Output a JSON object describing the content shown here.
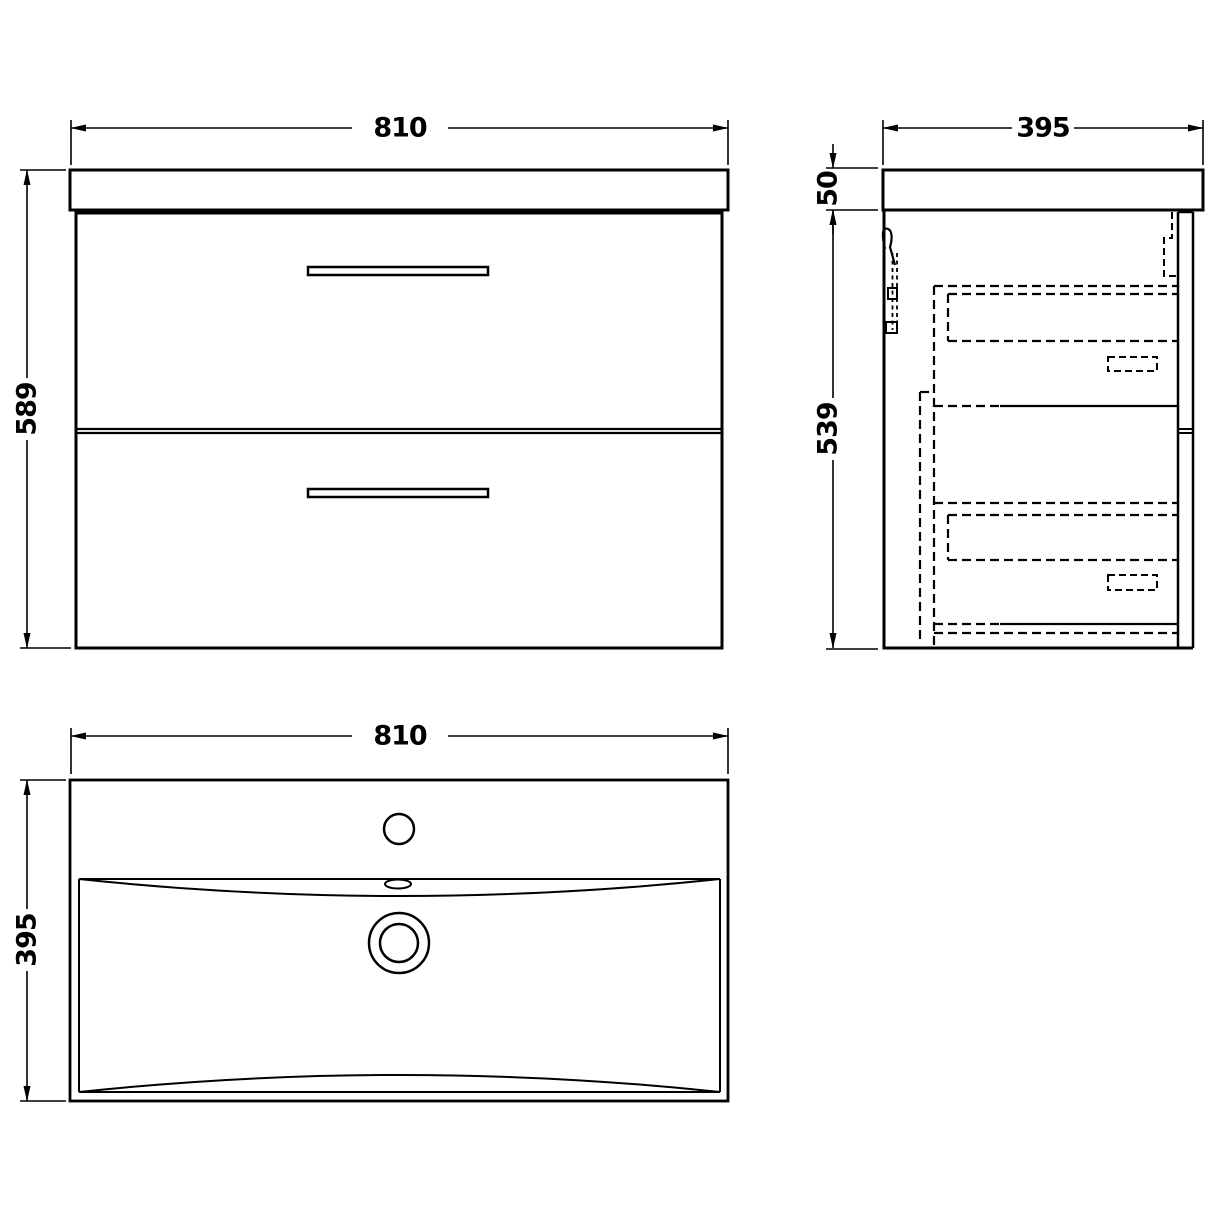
{
  "drawing": {
    "type": "technical-drawing",
    "subject": "wall-hung vanity unit with basin",
    "colors": {
      "background": "#ffffff",
      "line": "#000000"
    },
    "views": {
      "front": {
        "name": "front elevation",
        "dim_width": "810",
        "dim_height": "589"
      },
      "side": {
        "name": "side section",
        "dim_depth": "395",
        "dim_worktop_height": "50",
        "dim_cabinet_height": "539"
      },
      "plan": {
        "name": "basin plan",
        "dim_width": "810",
        "dim_depth": "395"
      }
    }
  }
}
